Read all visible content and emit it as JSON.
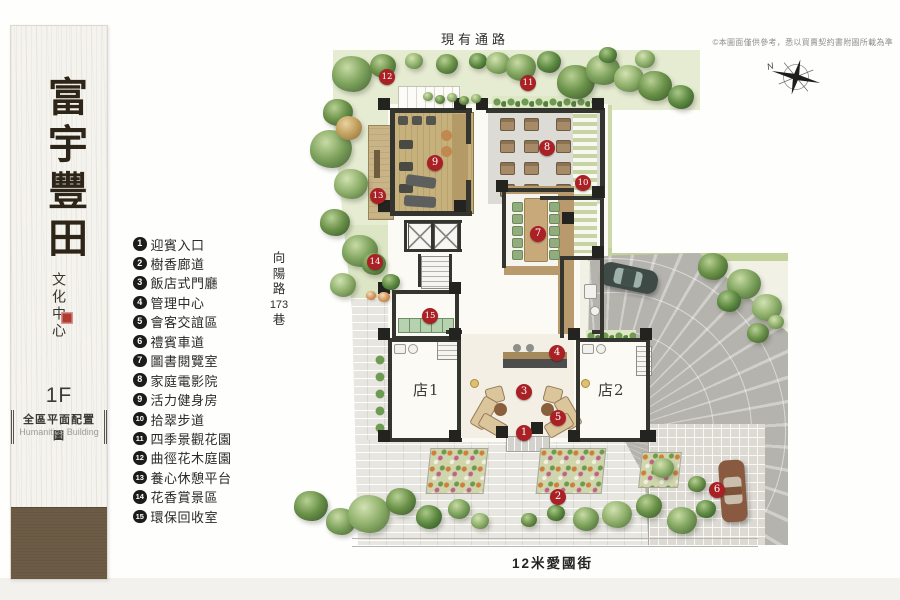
{
  "sidebar": {
    "title": "富宇豐田",
    "subtitle": "文化中心",
    "floor": "1F",
    "plan_name": "全區平面配置圖",
    "plan_name_en": "Humanities Building"
  },
  "legend": {
    "items": [
      {
        "n": "1",
        "label": "迎賓入口"
      },
      {
        "n": "2",
        "label": "樹香廊道"
      },
      {
        "n": "3",
        "label": "飯店式門廳"
      },
      {
        "n": "4",
        "label": "管理中心"
      },
      {
        "n": "5",
        "label": "會客交誼區"
      },
      {
        "n": "6",
        "label": "禮賓車道"
      },
      {
        "n": "7",
        "label": "圖書閱覽室"
      },
      {
        "n": "8",
        "label": "家庭電影院"
      },
      {
        "n": "9",
        "label": "活力健身房"
      },
      {
        "n": "10",
        "label": "拾翠步道"
      },
      {
        "n": "11",
        "label": "四季景觀花園"
      },
      {
        "n": "12",
        "label": "曲徑花木庭園"
      },
      {
        "n": "13",
        "label": "養心休憩平台"
      },
      {
        "n": "14",
        "label": "花香賞景區"
      },
      {
        "n": "15",
        "label": "環保回收室"
      }
    ]
  },
  "roads": {
    "top": "現有通路",
    "left": "向陽路173巷",
    "left_lines": [
      "向",
      "陽",
      "路",
      "173",
      "巷"
    ],
    "bottom": "12米愛國街"
  },
  "plan": {
    "shops": [
      {
        "label": "店1",
        "x": 427,
        "y": 388
      },
      {
        "label": "店2",
        "x": 612,
        "y": 388
      }
    ],
    "markers": [
      {
        "n": "1",
        "x": 524,
        "y": 433
      },
      {
        "n": "2",
        "x": 558,
        "y": 497
      },
      {
        "n": "3",
        "x": 524,
        "y": 392
      },
      {
        "n": "4",
        "x": 557,
        "y": 353
      },
      {
        "n": "5",
        "x": 558,
        "y": 418
      },
      {
        "n": "6",
        "x": 717,
        "y": 490
      },
      {
        "n": "7",
        "x": 538,
        "y": 234
      },
      {
        "n": "8",
        "x": 547,
        "y": 148
      },
      {
        "n": "9",
        "x": 435,
        "y": 163
      },
      {
        "n": "10",
        "x": 583,
        "y": 183
      },
      {
        "n": "11",
        "x": 528,
        "y": 83
      },
      {
        "n": "12",
        "x": 387,
        "y": 77
      },
      {
        "n": "13",
        "x": 378,
        "y": 196
      },
      {
        "n": "14",
        "x": 375,
        "y": 262
      },
      {
        "n": "15",
        "x": 430,
        "y": 316
      }
    ]
  },
  "compass": {
    "label": "N"
  },
  "disclaimer": "©本圖面僅供參考，悉以買賣契約書附圖所載為準",
  "colors": {
    "marker_red": "#a92025",
    "legend_black": "#1c1c1c",
    "seal_red": "#b23b30",
    "plank_brown": "#6d5c45"
  }
}
